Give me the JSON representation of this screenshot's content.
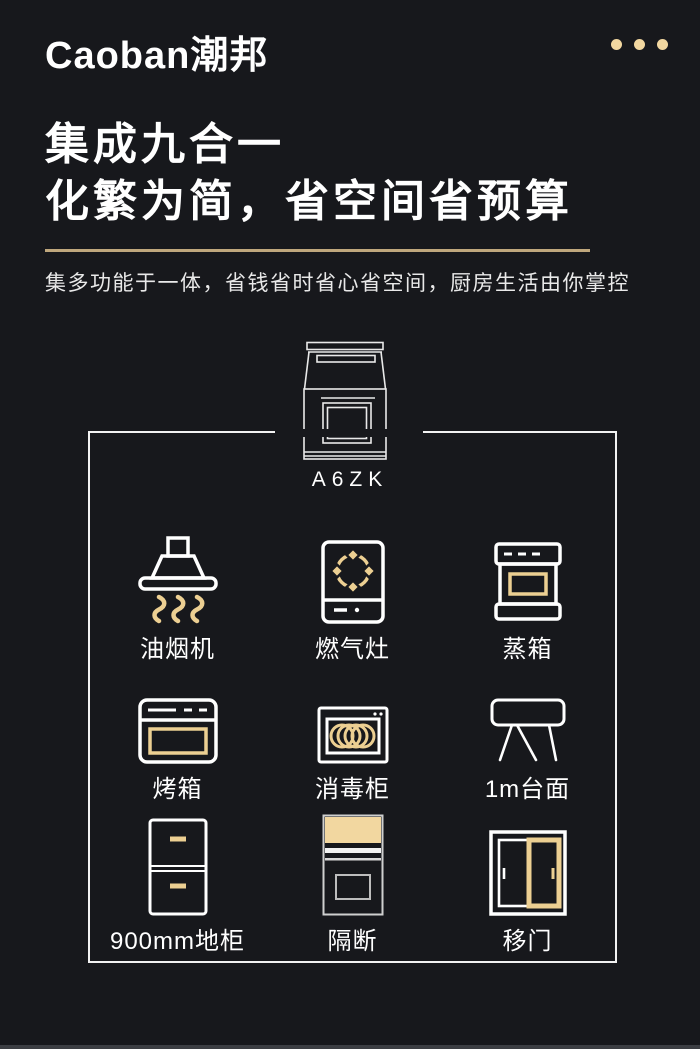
{
  "colors": {
    "background": "#17181c",
    "text_white": "#ffffff",
    "icon_white": "#ffffff",
    "accent_gold": "#eccf92",
    "solid_gold": "#f2d7a0",
    "rule_gold": "#bfa77d",
    "box_border": "#f2f2f2"
  },
  "header": {
    "logo_text": "Caoban潮邦",
    "menu_icon": "three-dots"
  },
  "hero": {
    "title_line1": "集成九合一",
    "title_line2": "化繁为简，省空间省预算",
    "subtitle": "集多功能于一体，省钱省时省心省空间，厨房生活由你掌控"
  },
  "product": {
    "model": "A6ZK",
    "illustration": "integrated-stove-outline"
  },
  "features": [
    {
      "id": "range-hood",
      "label": "油烟机"
    },
    {
      "id": "gas-stove",
      "label": "燃气灶"
    },
    {
      "id": "steam-oven",
      "label": "蒸箱"
    },
    {
      "id": "oven",
      "label": "烤箱"
    },
    {
      "id": "disinfection-cabinet",
      "label": "消毒柜"
    },
    {
      "id": "countertop-1m",
      "label": "1m台面"
    },
    {
      "id": "floor-cabinet-900mm",
      "label": "900mm地柜"
    },
    {
      "id": "partition",
      "label": "隔断"
    },
    {
      "id": "sliding-door",
      "label": "移门"
    }
  ]
}
